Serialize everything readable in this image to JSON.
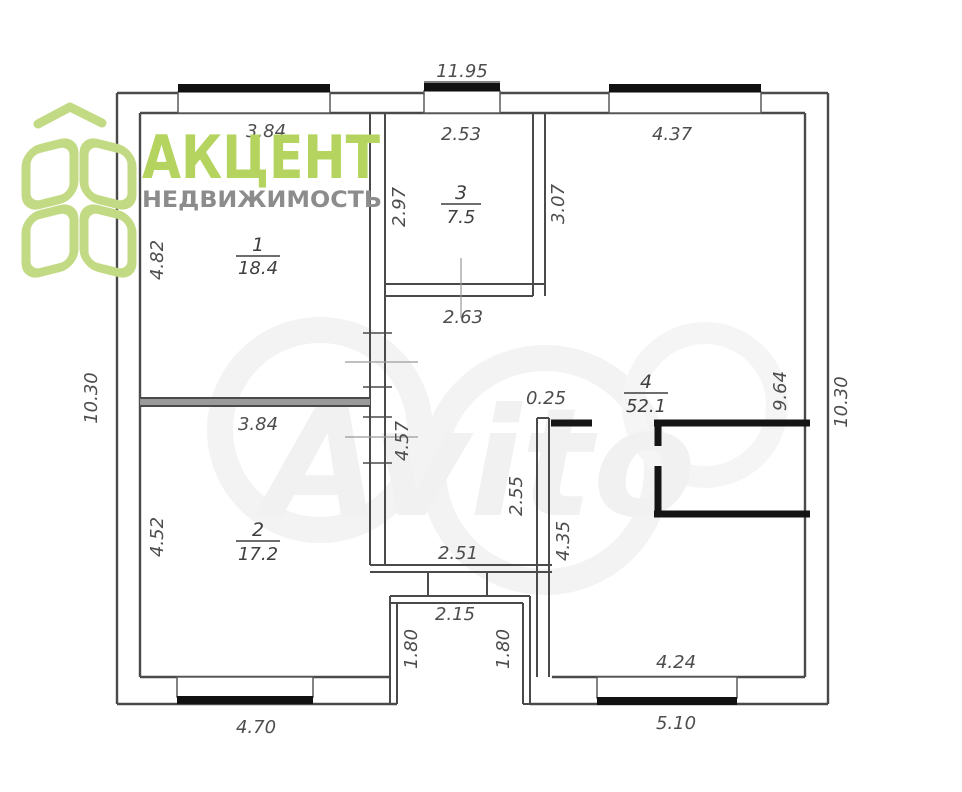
{
  "logo": {
    "brand": "АКЦЕНТ",
    "subtitle": "НЕДВИЖИМОСТЬ",
    "brand_color": "#b5d45f",
    "icon_color": "#c3da85",
    "subtitle_color": "#8c8c8c"
  },
  "watermark": {
    "text": "Avito"
  },
  "rooms": {
    "r1": {
      "number": "1",
      "area": "18.4"
    },
    "r2": {
      "number": "2",
      "area": "17.2"
    },
    "r3": {
      "number": "3",
      "area": "7.5"
    },
    "r4": {
      "number": "4",
      "area": "52.1"
    }
  },
  "dims": {
    "top_overall": "11.95",
    "win_top_left": "3.84",
    "room3_top": "2.53",
    "win_top_right": "4.37",
    "room1_height": "4.82",
    "room3_left": "2.97",
    "room3_right": "3.07",
    "room3_bottom": "2.63",
    "left_overall": "10.30",
    "right_overall": "10.30",
    "room2_top": "3.84",
    "hall_left": "4.57",
    "wall_stub": "0.25",
    "room4_right": "9.64",
    "room2_height": "4.52",
    "hall_wall": "2.55",
    "room4_left": "4.35",
    "hall_bottom": "2.51",
    "porch_width": "2.15",
    "porch_left": "1.80",
    "porch_right": "1.80",
    "room4_bottom": "4.24",
    "win_bottom_left": "4.70",
    "win_bottom_right": "5.10"
  },
  "colors": {
    "wall": "#4a4a4a",
    "partition": "#151515",
    "dim_text": "#4d4d4d"
  }
}
